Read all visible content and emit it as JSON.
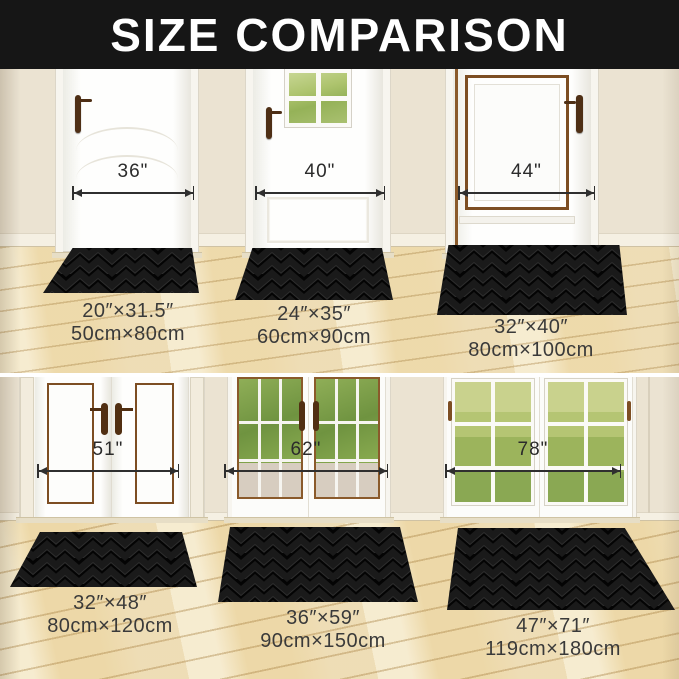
{
  "title": "SIZE COMPARISON",
  "panels": [
    {
      "door_width": "36\"",
      "mat_inches": "20″×31.5″",
      "mat_cm": "50cm×80cm"
    },
    {
      "door_width": "40\"",
      "mat_inches": "24″×35″",
      "mat_cm": "60cm×90cm"
    },
    {
      "door_width": "44\"",
      "mat_inches": "32″×40″",
      "mat_cm": "80cm×100cm"
    },
    {
      "door_width": "51\"",
      "mat_inches": "32″×48″",
      "mat_cm": "80cm×120cm"
    },
    {
      "door_width": "62\"",
      "mat_inches": "36″×59″",
      "mat_cm": "90cm×150cm"
    },
    {
      "door_width": "78\"",
      "mat_inches": "47″×71″",
      "mat_cm": "119cm×180cm"
    }
  ],
  "colors": {
    "banner_bg": "#161616",
    "mat": "#1a1a1a",
    "wall": "#ebe3d2",
    "floor": "#ecd9ae",
    "wood_trim": "#7d4e23",
    "dimension": "#2f2f2f"
  }
}
